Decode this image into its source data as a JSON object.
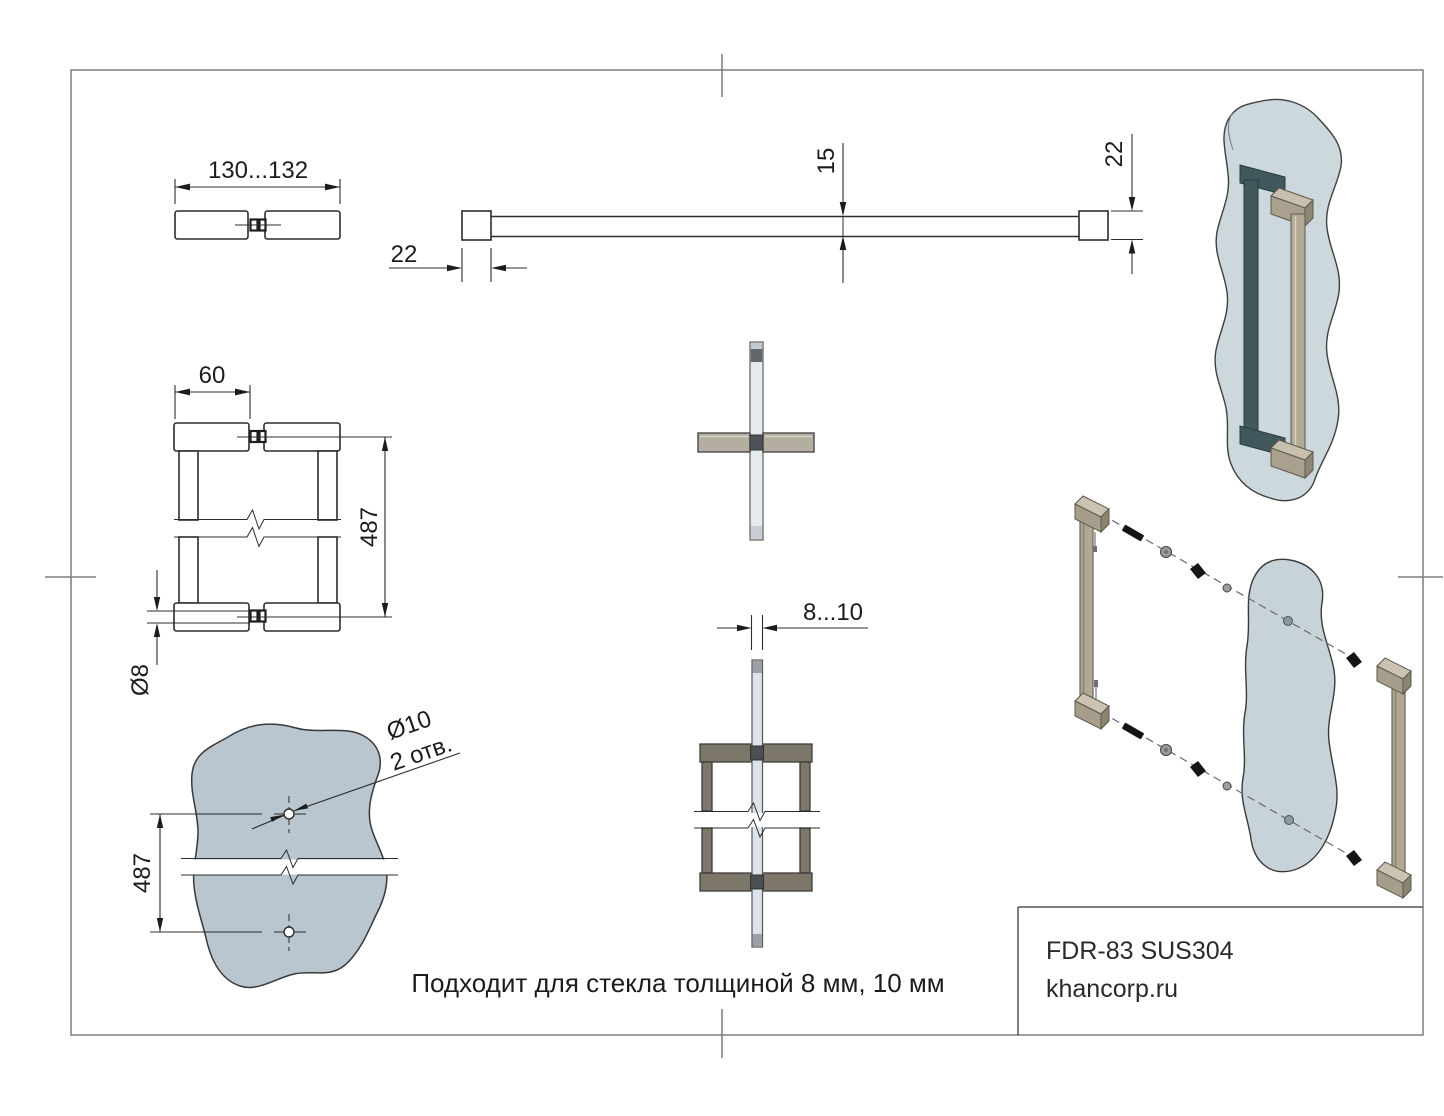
{
  "title_block": {
    "model": "FDR-83 SUS304",
    "website": "khancorp.ru"
  },
  "note": "Подходит для стекла толщиной 8 мм, 10 мм",
  "dims": {
    "overall_length": "130...132",
    "cap_section": "22",
    "bar_height": "15",
    "cap_section_side": "22",
    "cap_width": "60",
    "centers": "487",
    "spigot_dia": "Ø8",
    "glass_thickness": "8...10",
    "hole_dia": "Ø10",
    "hole_count": "2 отв.",
    "glass_centers": "487"
  },
  "colors": {
    "line": "#2c2c2c",
    "glass_render": "#cdd8dc",
    "glass_panel": "#b9c6cf",
    "glass_exploded": "#c7d3d9",
    "handle_tan": "#b1a995",
    "handle_teal": "#40585c",
    "cap_grey": "#b4aea1",
    "cap_olive": "#7d7769",
    "connector_dark": "#4c5255"
  }
}
